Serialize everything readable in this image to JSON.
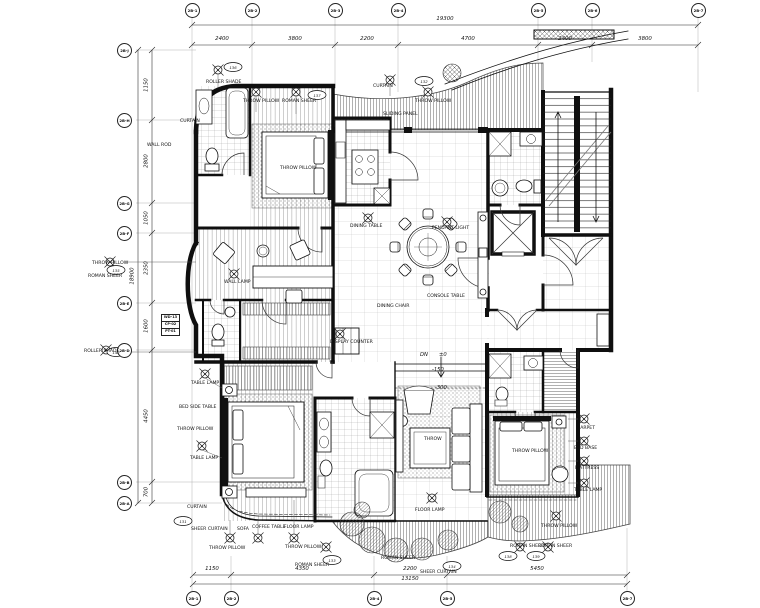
{
  "grid_top": {
    "labels": [
      "2B-1",
      "2B-2",
      "2B-3",
      "2B-4",
      "2B-5",
      "2B-6",
      "2B-7"
    ],
    "dims": [
      "2400",
      "3800",
      "2200",
      "4700",
      "2400",
      "3800"
    ],
    "overall": "19300"
  },
  "grid_bottom": {
    "labels": [
      "2B-1",
      "2B-2",
      "2B-4",
      "2B-5",
      "2B-7"
    ],
    "dims": [
      "1150",
      "4350",
      "2200",
      "5450"
    ],
    "overall": "13150"
  },
  "grid_left": {
    "labels": [
      "2B-J",
      "2B-H",
      "2B-G",
      "2B-F",
      "2B-E",
      "2B-D",
      "2B-B",
      "2B-A"
    ],
    "dims": [
      "1150",
      "2800",
      "1050",
      "2350",
      "1600",
      "4450",
      "700"
    ],
    "overall": "18900"
  },
  "levels": {
    "dn": "DN",
    "zero": "±0",
    "m150": "-150",
    "m300": "-300"
  },
  "annotations": [
    {
      "label": "ROLLER SHADE"
    },
    {
      "label": "THROW PILLOW"
    },
    {
      "label": "ROMAN SHEER"
    },
    {
      "label": "CURTAIN"
    },
    {
      "label": "THROW PILLOW"
    },
    {
      "label": "SLIDING PANEL"
    },
    {
      "label": "CURTAIN"
    },
    {
      "label": "WALL ROD"
    },
    {
      "label": "THROW PILLOW"
    },
    {
      "label": "ROMAN SHEER"
    },
    {
      "label": "ROLLER SHADE"
    },
    {
      "label": "DINING TABLE"
    },
    {
      "label": "PENDANT LIGHT"
    },
    {
      "label": "CONSOLE TABLE"
    },
    {
      "label": "DINING CHAIR"
    },
    {
      "label": "DISPLAY COUNTER"
    },
    {
      "label": "WALL LAMP"
    },
    {
      "label": "TABLE LAMP"
    },
    {
      "label": "BED SIDE TABLE"
    },
    {
      "label": "THROW PILLOW"
    },
    {
      "label": "TABLE LAMP"
    },
    {
      "label": "CURTAIN"
    },
    {
      "label": "SHEER CURTAIN"
    },
    {
      "label": "SOFA"
    },
    {
      "label": "COFFEE TABLE"
    },
    {
      "label": "FLOOR LAMP"
    },
    {
      "label": "THROW PILLOW"
    },
    {
      "label": "THROW PILLOW"
    },
    {
      "label": "ROMAN SHEER"
    },
    {
      "label": "THROW"
    },
    {
      "label": "FLOOR LAMP"
    },
    {
      "label": "CARPET"
    },
    {
      "label": "BED BASE"
    },
    {
      "label": "MATTRESS"
    },
    {
      "label": "TABLE LAMP"
    },
    {
      "label": "THROW PILLOW"
    },
    {
      "label": "ROMAN SHEER"
    },
    {
      "label": "ROMAN SHEER"
    },
    {
      "label": "SHEER CURTAIN"
    },
    {
      "label": "ROMAN SHEER"
    },
    {
      "label": "THROW PILLOW"
    },
    {
      "label": "THROW PILLOW"
    }
  ],
  "tags": [
    "136",
    "137",
    "132",
    "135",
    "142",
    "131",
    "133",
    "138",
    "139",
    "134"
  ],
  "finish_tags": [
    "WD-13",
    "CP-02",
    "PT-01"
  ],
  "colors": {
    "line": "#0f0f0f",
    "hatch": "#888888",
    "background": "#ffffff"
  }
}
